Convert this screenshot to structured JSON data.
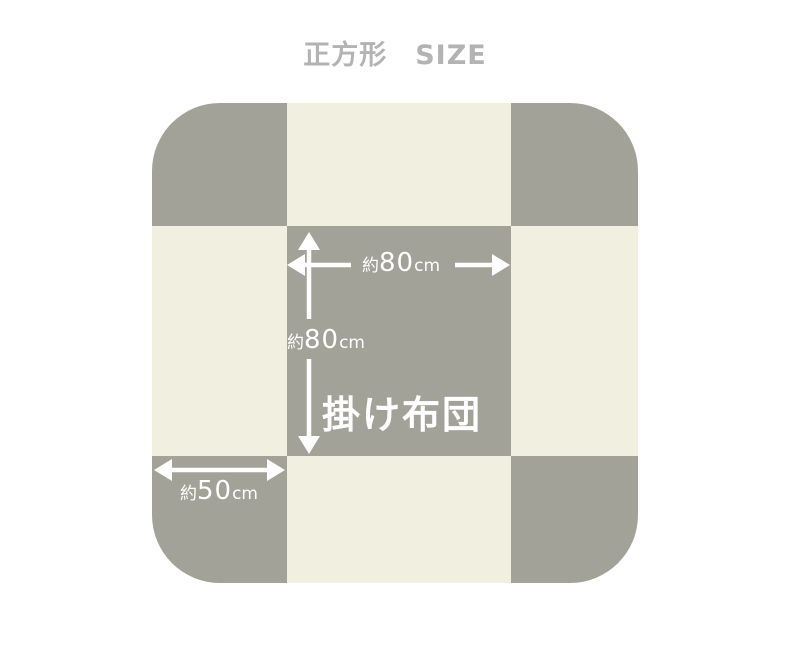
{
  "page": {
    "title": "正方形　SIZE"
  },
  "diagram": {
    "futon_label": "掛け布団",
    "colors": {
      "gray": "#a3a299",
      "cream": "#f0efe0",
      "title_gray": "#b3b3b3",
      "arrow": "#ffffff"
    },
    "dimensions": {
      "width": {
        "prefix": "約",
        "value": "80",
        "unit": "cm"
      },
      "height": {
        "prefix": "約",
        "value": "80",
        "unit": "cm"
      },
      "side": {
        "prefix": "約",
        "value": "50",
        "unit": "cm"
      }
    }
  }
}
